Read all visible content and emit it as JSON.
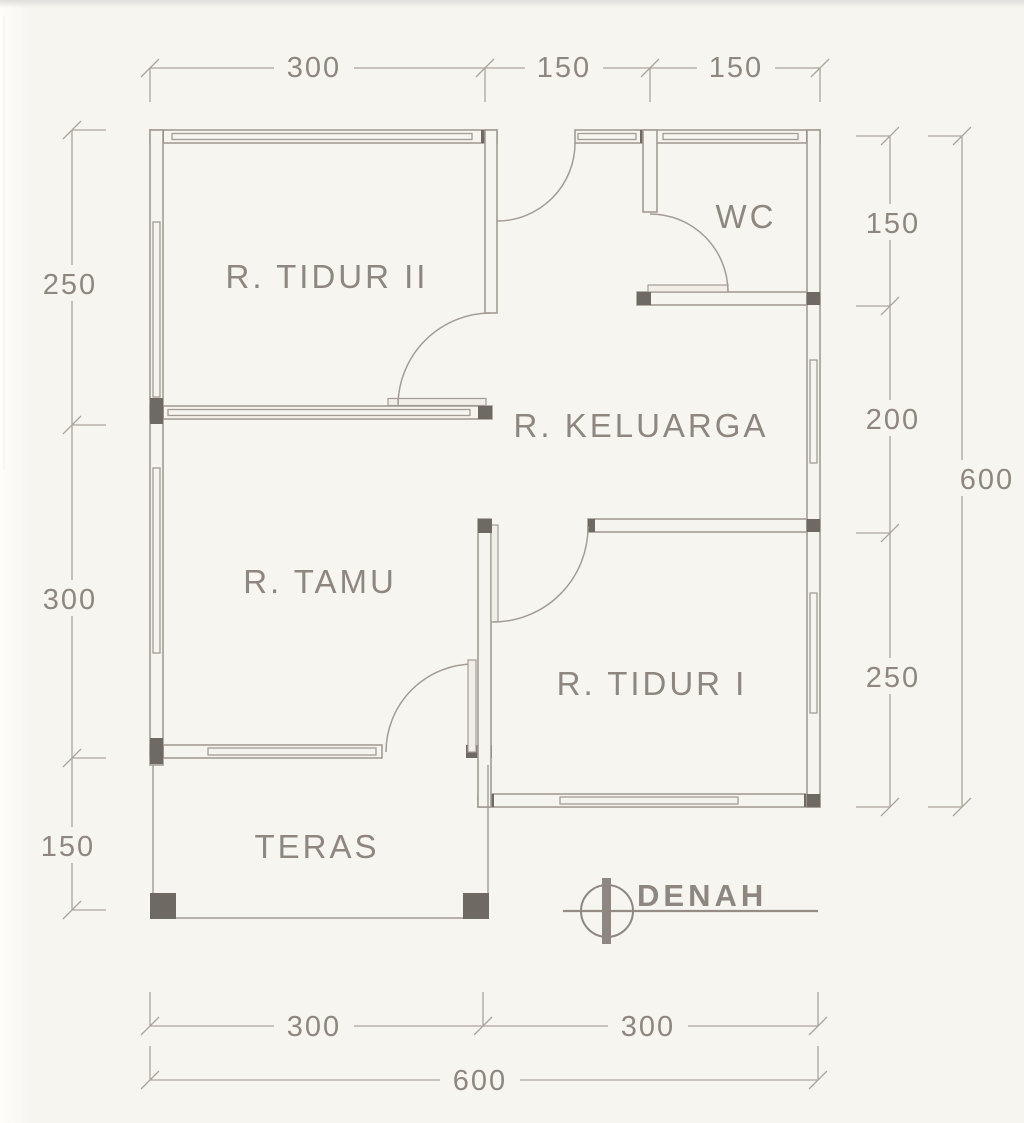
{
  "plan": {
    "title": "DENAH",
    "rooms": {
      "tidur2": "R. TIDUR II",
      "wc": "WC",
      "keluarga": "R. KELUARGA",
      "tamu": "R. TAMU",
      "tidur1": "R. TIDUR I",
      "teras": "TERAS"
    },
    "dims": {
      "top": {
        "seg1": "300",
        "seg2": "150",
        "seg3": "150"
      },
      "left": {
        "seg1": "250",
        "seg2": "300",
        "seg3": "150"
      },
      "right": {
        "seg1": "150",
        "seg2": "200",
        "seg3": "250",
        "total": "600"
      },
      "bottom": {
        "seg1": "300",
        "seg2": "300",
        "total": "600"
      }
    },
    "colors": {
      "paper": "#f7f5f0",
      "line": "#a29c95",
      "ink": "#8d8780",
      "post": "#6e6963"
    }
  }
}
